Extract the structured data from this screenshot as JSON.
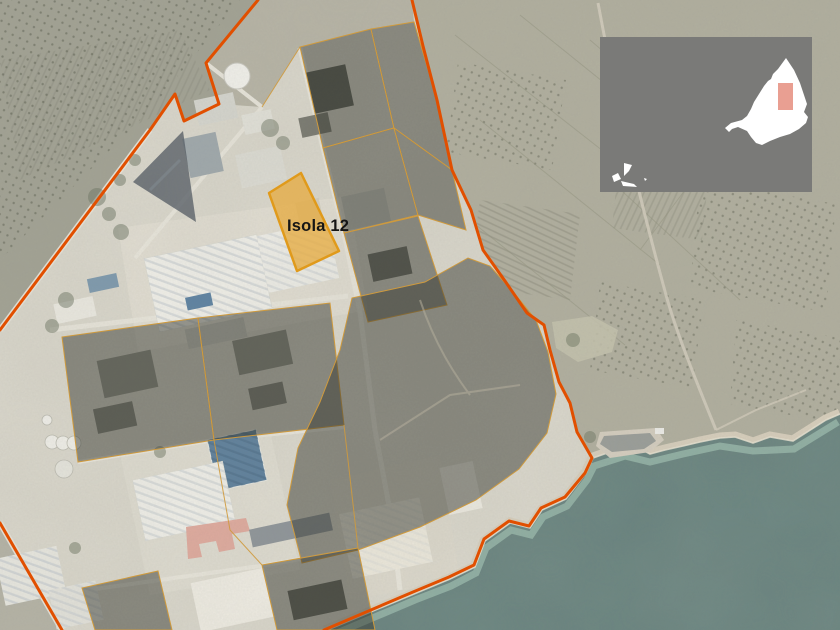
{
  "map": {
    "type": "satellite-annotation-map",
    "highlight": {
      "label": "Isola 12"
    },
    "colors": {
      "boundary": "#e14f00",
      "parcel_line": "#cf9a3d",
      "parcel_fill": "#34362f",
      "highlight_fill": "#e6ac42",
      "highlight_stroke": "#e09a1b",
      "label": "#151515",
      "sea": "#68827e",
      "sea_shallow": "#9fc0b2",
      "land": "#a7a599",
      "zone_ground": "#dad7cc",
      "inset_background": "#7a7a78",
      "inset_land": "#ffffff",
      "inset_marker": "#e99f92"
    }
  }
}
